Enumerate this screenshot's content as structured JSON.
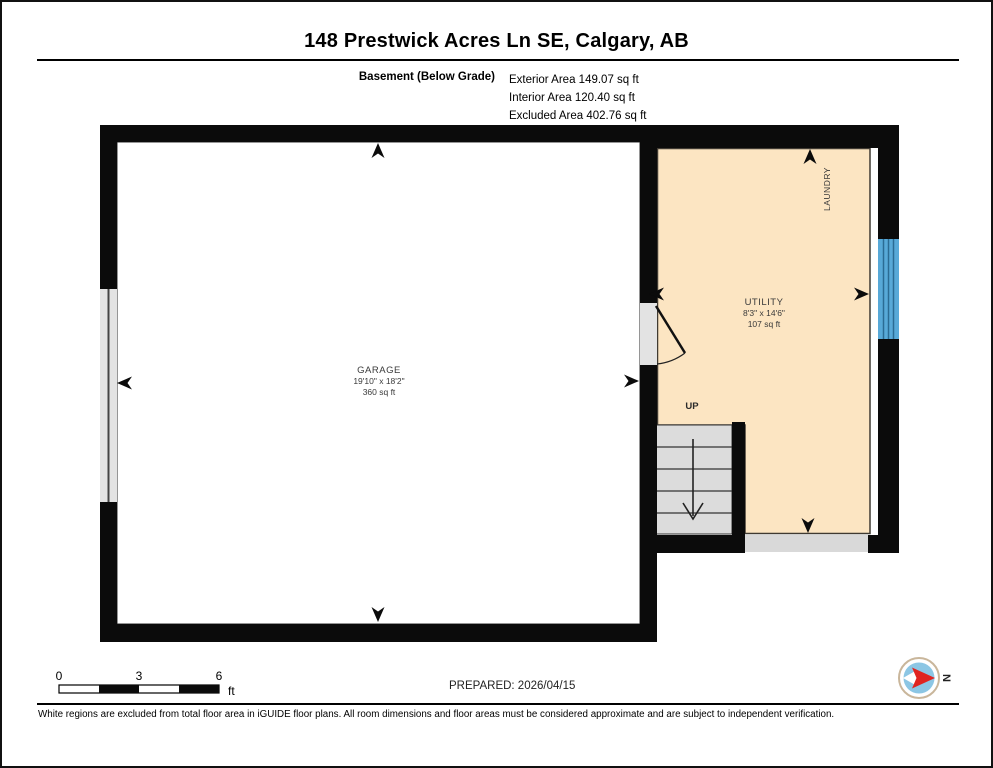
{
  "header": {
    "title": "148 Prestwick Acres Ln SE, Calgary, AB",
    "floor_label": "Basement (Below Grade)",
    "areas": [
      "Exterior Area 149.07 sq ft",
      "Interior Area 120.40 sq ft",
      "Excluded Area 402.76 sq ft"
    ]
  },
  "plan": {
    "garage": {
      "name": "GARAGE",
      "dims": "19'10\" x 18'2\"",
      "area": "360 sq ft"
    },
    "utility": {
      "name": "UTILITY",
      "dims": "8'3\" x 14'6\"",
      "area": "107 sq ft"
    },
    "laundry_label": "LAUNDRY",
    "up_label": "UP"
  },
  "footer": {
    "scale": {
      "t0": "0",
      "t3": "3",
      "t6": "6",
      "unit": "ft"
    },
    "prepared": "PREPARED: 2026/04/15",
    "compass_n": "N",
    "disclaimer": "White regions are excluded from total floor area in iGUIDE floor plans. All room dimensions and floor areas must be considered approximate and are subject to independent verification."
  },
  "colors": {
    "wall": "#0b0b0b",
    "room_fill": "#fce5c2",
    "window_fill": "#58a9d8",
    "window_line": "#2b6b94",
    "stairs_fill": "#dcdcdc",
    "excluded_fill": "#d9d9d9",
    "opening_fill": "#e3e3e3",
    "compass_blue": "#8cc6e4",
    "compass_red": "#e02420"
  }
}
